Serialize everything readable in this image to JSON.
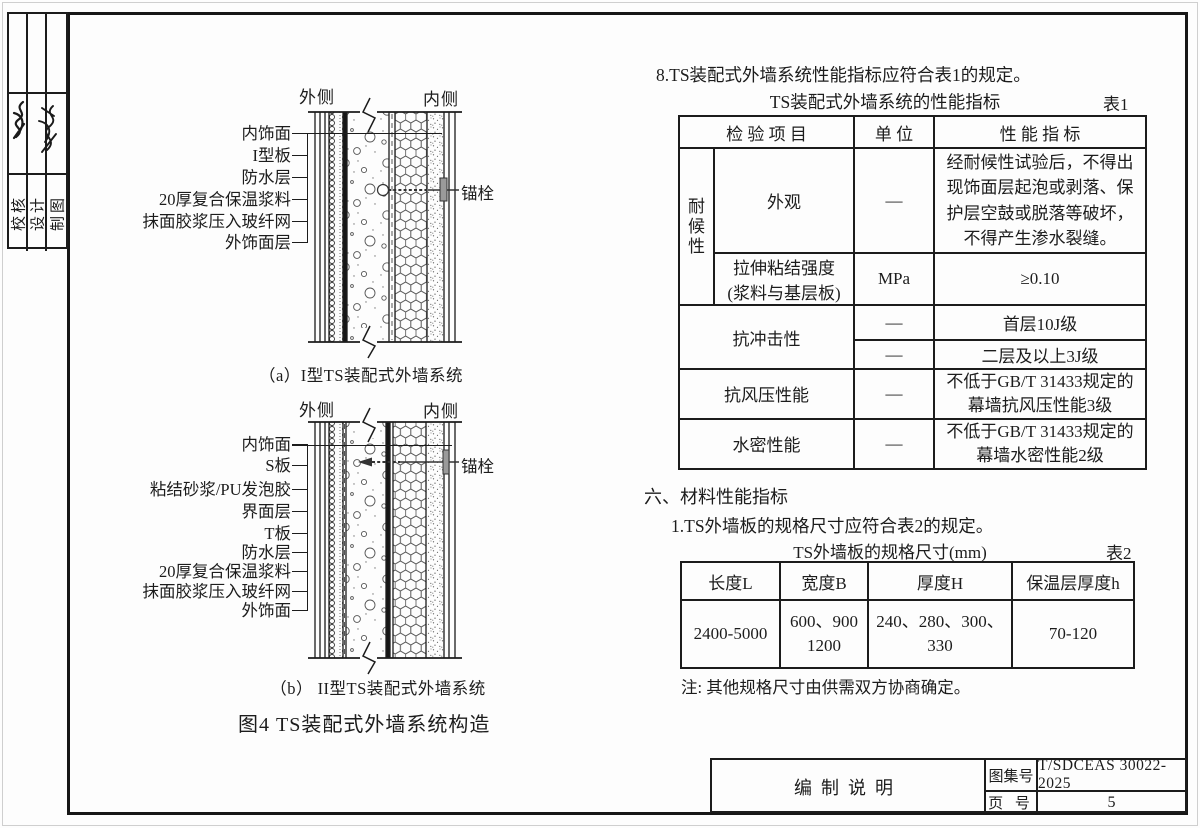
{
  "stamp_column": {
    "row_labels": [
      "校核",
      "设计",
      "制图"
    ]
  },
  "diagram_a": {
    "side_left": "外侧",
    "side_right": "内侧",
    "layer_labels": [
      "内饰面",
      "I型板",
      "防水层",
      "20厚复合保温浆料",
      "抹面胶浆压入玻纤网",
      "外饰面层"
    ],
    "anchor_label": "锚栓",
    "caption": "（a）I型TS装配式外墙系统"
  },
  "diagram_b": {
    "side_left": "外侧",
    "side_right": "内侧",
    "layer_labels": [
      "内饰面",
      "S板",
      "粘结砂浆/PU发泡胶",
      "界面层",
      "T板",
      "防水层",
      "20厚复合保温浆料",
      "抹面胶浆压入玻纤网",
      "外饰面"
    ],
    "anchor_label": "锚栓",
    "caption": "（b） II型TS装配式外墙系统"
  },
  "figure_caption": "图4  TS装配式外墙系统构造",
  "section8_text": "8.TS装配式外墙系统性能指标应符合表1的规定。",
  "table1": {
    "title": "TS装配式外墙系统的性能指标",
    "tag": "表1",
    "col_headers": [
      "检 验 项 目",
      "单 位",
      "性 能 指 标"
    ],
    "group_label": "耐候性",
    "rows": {
      "appearance": {
        "item": "外观",
        "unit": "—",
        "value": "经耐候性试验后，不得出现饰面层起泡或剥落、保护层空鼓或脱落等破坏，不得产生渗水裂缝。"
      },
      "tensile": {
        "item": "拉伸粘结强度\n(浆料与基层板)",
        "unit": "MPa",
        "value": "≥0.10"
      },
      "impact": {
        "item": "抗冲击性",
        "unit_a": "—",
        "value_a": "首层10J级",
        "unit_b": "—",
        "value_b": "二层及以上3J级"
      },
      "wind": {
        "item": "抗风压性能",
        "unit": "—",
        "value": "不低于GB/T 31433规定的\n幕墙抗风压性能3级"
      },
      "water": {
        "item": "水密性能",
        "unit": "—",
        "value": "不低于GB/T 31433规定的\n幕墙水密性能2级"
      }
    }
  },
  "section6": {
    "heading": "六、材料性能指标",
    "item1": "1.TS外墙板的规格尺寸应符合表2的规定。"
  },
  "table2": {
    "title": "TS外墙板的规格尺寸(mm)",
    "tag": "表2",
    "col_headers": [
      "长度L",
      "宽度B",
      "厚度H",
      "保温层厚度h"
    ],
    "row": [
      "2400-5000",
      "600、900\n1200",
      "240、280、300、\n330",
      "70-120"
    ],
    "note": "注: 其他规格尺寸由供需双方协商确定。"
  },
  "title_block": {
    "title": "编制说明",
    "atlas_label": "图集号",
    "atlas_value": "T/SDCEAS 30022-2025",
    "page_label": "页 号",
    "page_value": "5"
  }
}
